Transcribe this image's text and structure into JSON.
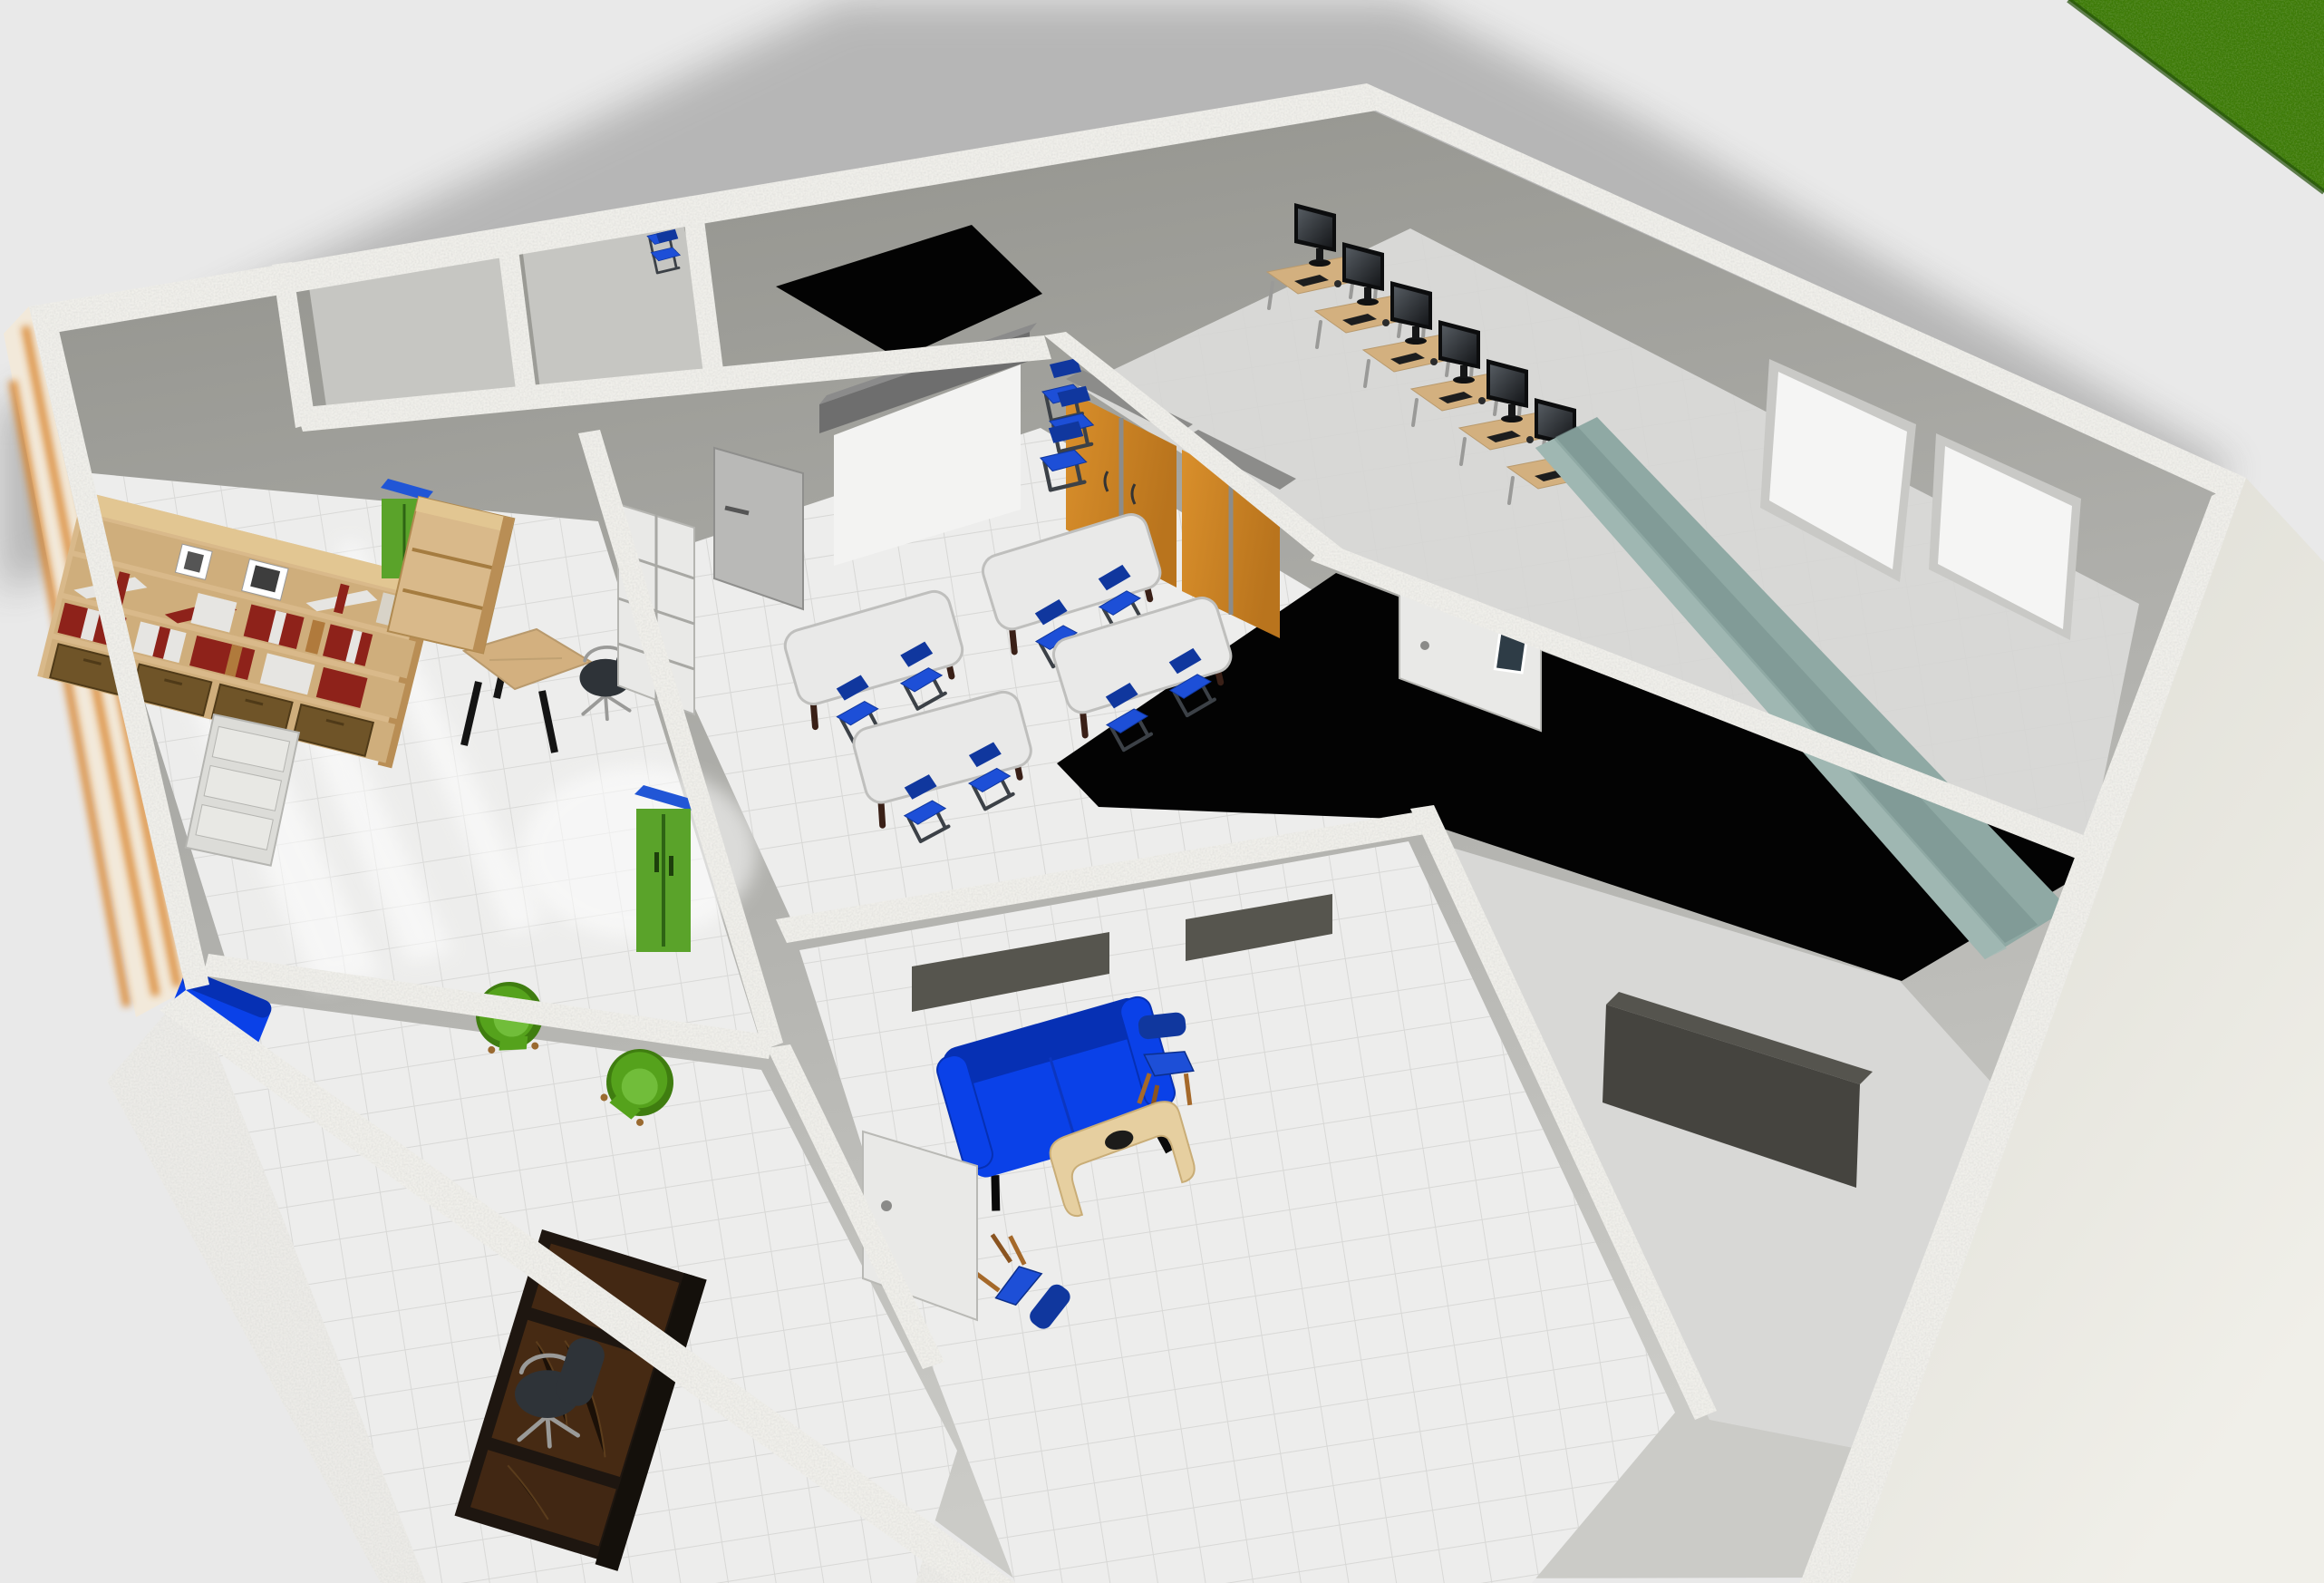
{
  "scene": {
    "description": "3D overhead rendering of a school floor plan: library, two small storage rooms, classroom, computer lab, lounge, office, two dark unlit rooms, grass visible at top-right corner, soft shadow cast to the upper left",
    "software_style": "home design 3D view",
    "visible_text": "none"
  },
  "colors": {
    "bg": "#e9e9e9",
    "shadow": "#b2b2b2",
    "grass": "#3c7a10",
    "grassDark": "#2c5d0a",
    "wallTop": "#f0efea",
    "interiorTopDark": "#90908a",
    "interiorLight": "#cbcbc7",
    "exteriorBeige": "#e3e2d9",
    "swFace": "#ecebe7",
    "black": "#030303",
    "floorLight": "#ededec",
    "floorGray": "#d8d8d6",
    "smallRoomFloor": "#c6c6c2",
    "floorTileLine": "#d4d4d2",
    "orange": "#d98f2b",
    "orangeDark": "#b9741d",
    "cabinetTop": "#8c8c8a",
    "blueChair": "#1d4fd7",
    "blueChairDark": "#10379e",
    "chairFrame": "#3c4147",
    "tableLeg": "#3a2017",
    "blueSofa": "#0a41e8",
    "blueSofaDark": "#0630b4",
    "greenChair": "#55a21c",
    "greenChairDark": "#3f7d10",
    "greenSeat": "#71bd3a",
    "greenCabinet": "#5aa32a",
    "blueCabinetTop": "#2156d6",
    "teal": "#8fa9a4",
    "tealDark": "#7b9691",
    "monitorBlack": "#0c0d0e",
    "screenGlow": "#6a7177",
    "deskWood": "#d3b07f",
    "wood": "#d9b98a",
    "woodDark": "#b98e55",
    "woodStreak": "#d9842b",
    "darkDesk": "#1e1610",
    "darkDeskPanel": "#4a2c14",
    "redBook": "#8e221a",
    "bookWhite": "#e6e5e2",
    "basket": "#6f5428",
    "whiteBoard": "#f5f5f4",
    "doorGray": "#b9b9b7",
    "doorWhite": "#e9e9e7",
    "screenCase": "#6e6e6e",
    "screenWhite": "#f3f3f2",
    "slotDark": "#56554e",
    "officeChair": "#2e3338",
    "metal": "#9a9a98",
    "sideboard": "#45443f",
    "tableTop": "#e9e9e8"
  },
  "rooms": [
    {
      "id": "library",
      "label": "Library / reading room"
    },
    {
      "id": "small-room-1",
      "label": "Small empty room"
    },
    {
      "id": "small-room-2",
      "label": "Small empty room"
    },
    {
      "id": "dark-room-small",
      "label": "Small dark-ceiling room"
    },
    {
      "id": "classroom",
      "label": "Classroom"
    },
    {
      "id": "computer-lab",
      "label": "Computer lab"
    },
    {
      "id": "dark-room-large",
      "label": "Large dark room"
    },
    {
      "id": "lounge",
      "label": "Lounge / waiting room"
    },
    {
      "id": "office",
      "label": "Office"
    },
    {
      "id": "storage-right",
      "label": "Room with sideboard"
    }
  ],
  "furniture": {
    "bookshelf": {
      "qty": 1,
      "contents": "red and white books, picture frames, 4 wicker baskets"
    },
    "library_desk": {
      "qty": 1,
      "top": "light wood",
      "legs": "black"
    },
    "office_swivel_chairs": {
      "qty": 2
    },
    "green_armchairs": {
      "qty": 2
    },
    "blue_bench_left": {
      "qty": 1
    },
    "white_drawer_units": {
      "qty": 1
    },
    "wooden_dresser": {
      "qty": 1
    },
    "green_cabinets_blue_top": {
      "qty": 2
    },
    "classroom_tables": {
      "qty": 4,
      "chairs_per_table": 2,
      "chair_color": "blue"
    },
    "stacked_blue_chairs": {
      "qty": 2
    },
    "orange_cabinets": {
      "qty": 2
    },
    "projector_screen": {
      "qty": 1
    },
    "computer_workstations": {
      "qty": 6,
      "monitor": "black LCD"
    },
    "teal_tiered_bench": {
      "qty": 1
    },
    "whiteboard_panels": {
      "qty": 2
    },
    "blue_sofa": {
      "qty": 1
    },
    "lounge_blue_chairs": {
      "qty": 2
    },
    "coffee_table": {
      "qty": 1,
      "material": "curved light wood"
    },
    "executive_desk": {
      "qty": 1,
      "finish": "dark wood with marble panels"
    },
    "sideboard": {
      "qty": 1
    },
    "doors": {
      "gray": 1,
      "white": 2,
      "french_glass": 1
    }
  }
}
